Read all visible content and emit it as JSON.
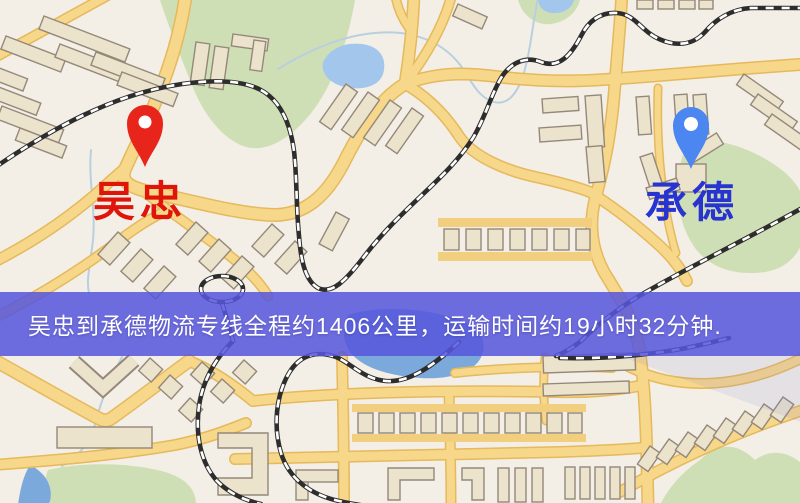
{
  "map": {
    "origin_label": "吴忠",
    "destination_label": "承德",
    "origin_pin_color": "#e8251a",
    "destination_pin_color": "#4c86f0",
    "origin_label_color": "#e01408",
    "destination_label_color": "#2734cf"
  },
  "banner": {
    "text": "吴忠到承德物流专线全程约1406公里，运输时间约19小时32分钟.",
    "background": "#5656dc",
    "text_color": "#ffffff"
  },
  "palette": {
    "land": "#f3efe6",
    "road": "#f7d78a",
    "road_casing": "#e5b95c",
    "building": "#ebe3cc",
    "building_outline": "#95887a",
    "green_area": "#cfdfb5",
    "water": "#a3c7ec",
    "railway": "#2e2d2d"
  }
}
